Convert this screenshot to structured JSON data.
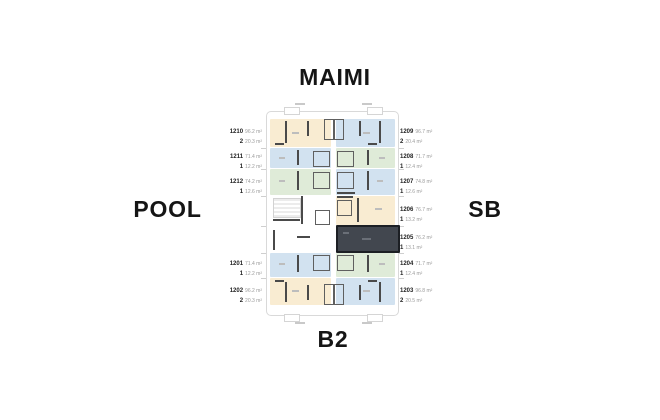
{
  "compass": {
    "top": "MAIMI",
    "left": "POOL",
    "right": "SB",
    "bottom": "B2"
  },
  "units": {
    "left": [
      {
        "number": "1210",
        "area": "96.2 m²",
        "beds": "2",
        "terrace": "20.3 m²",
        "color": "cream",
        "highlighted": false
      },
      {
        "number": "1211",
        "area": "71.4 m²",
        "beds": "1",
        "terrace": "12.2 m²",
        "color": "blue",
        "highlighted": false
      },
      {
        "number": "1212",
        "area": "74.2 m²",
        "beds": "1",
        "terrace": "12.6 m²",
        "color": "green",
        "highlighted": false
      },
      {
        "number": "1201",
        "area": "71.4 m²",
        "beds": "1",
        "terrace": "12.2 m²",
        "color": "blue",
        "highlighted": false
      },
      {
        "number": "1202",
        "area": "96.2 m²",
        "beds": "2",
        "terrace": "20.3 m²",
        "color": "cream",
        "highlighted": false
      }
    ],
    "right": [
      {
        "number": "1209",
        "area": "96.7 m²",
        "beds": "2",
        "terrace": "20.4 m²",
        "color": "blue",
        "highlighted": false
      },
      {
        "number": "1208",
        "area": "71.7 m²",
        "beds": "1",
        "terrace": "12.4 m²",
        "color": "green",
        "highlighted": false
      },
      {
        "number": "1207",
        "area": "74.8 m²",
        "beds": "1",
        "terrace": "12.6 m²",
        "color": "blue",
        "highlighted": false
      },
      {
        "number": "1206",
        "area": "76.7 m²",
        "beds": "1",
        "terrace": "13.2 m²",
        "color": "cream",
        "highlighted": false
      },
      {
        "number": "1205",
        "area": "76.2 m²",
        "beds": "1",
        "terrace": "13.1 m²",
        "color": "dark",
        "highlighted": true
      },
      {
        "number": "1204",
        "area": "71.7 m²",
        "beds": "1",
        "terrace": "12.4 m²",
        "color": "green",
        "highlighted": false
      },
      {
        "number": "1203",
        "area": "96.8 m²",
        "beds": "2",
        "terrace": "20.5 m²",
        "color": "blue",
        "highlighted": false
      }
    ]
  },
  "colors": {
    "background": "#ffffff",
    "unit_cream": "#f9ecd2",
    "unit_blue": "#d2e2f0",
    "unit_green": "#dfebd8",
    "unit_selected": "#42474f",
    "unit_selected_border": "#1c1f24",
    "plan_outline": "#d9d9d9",
    "walls": "#4a4a4a",
    "label_number": "#222222",
    "label_area": "#9b9b9b",
    "compass_text": "#151515"
  }
}
